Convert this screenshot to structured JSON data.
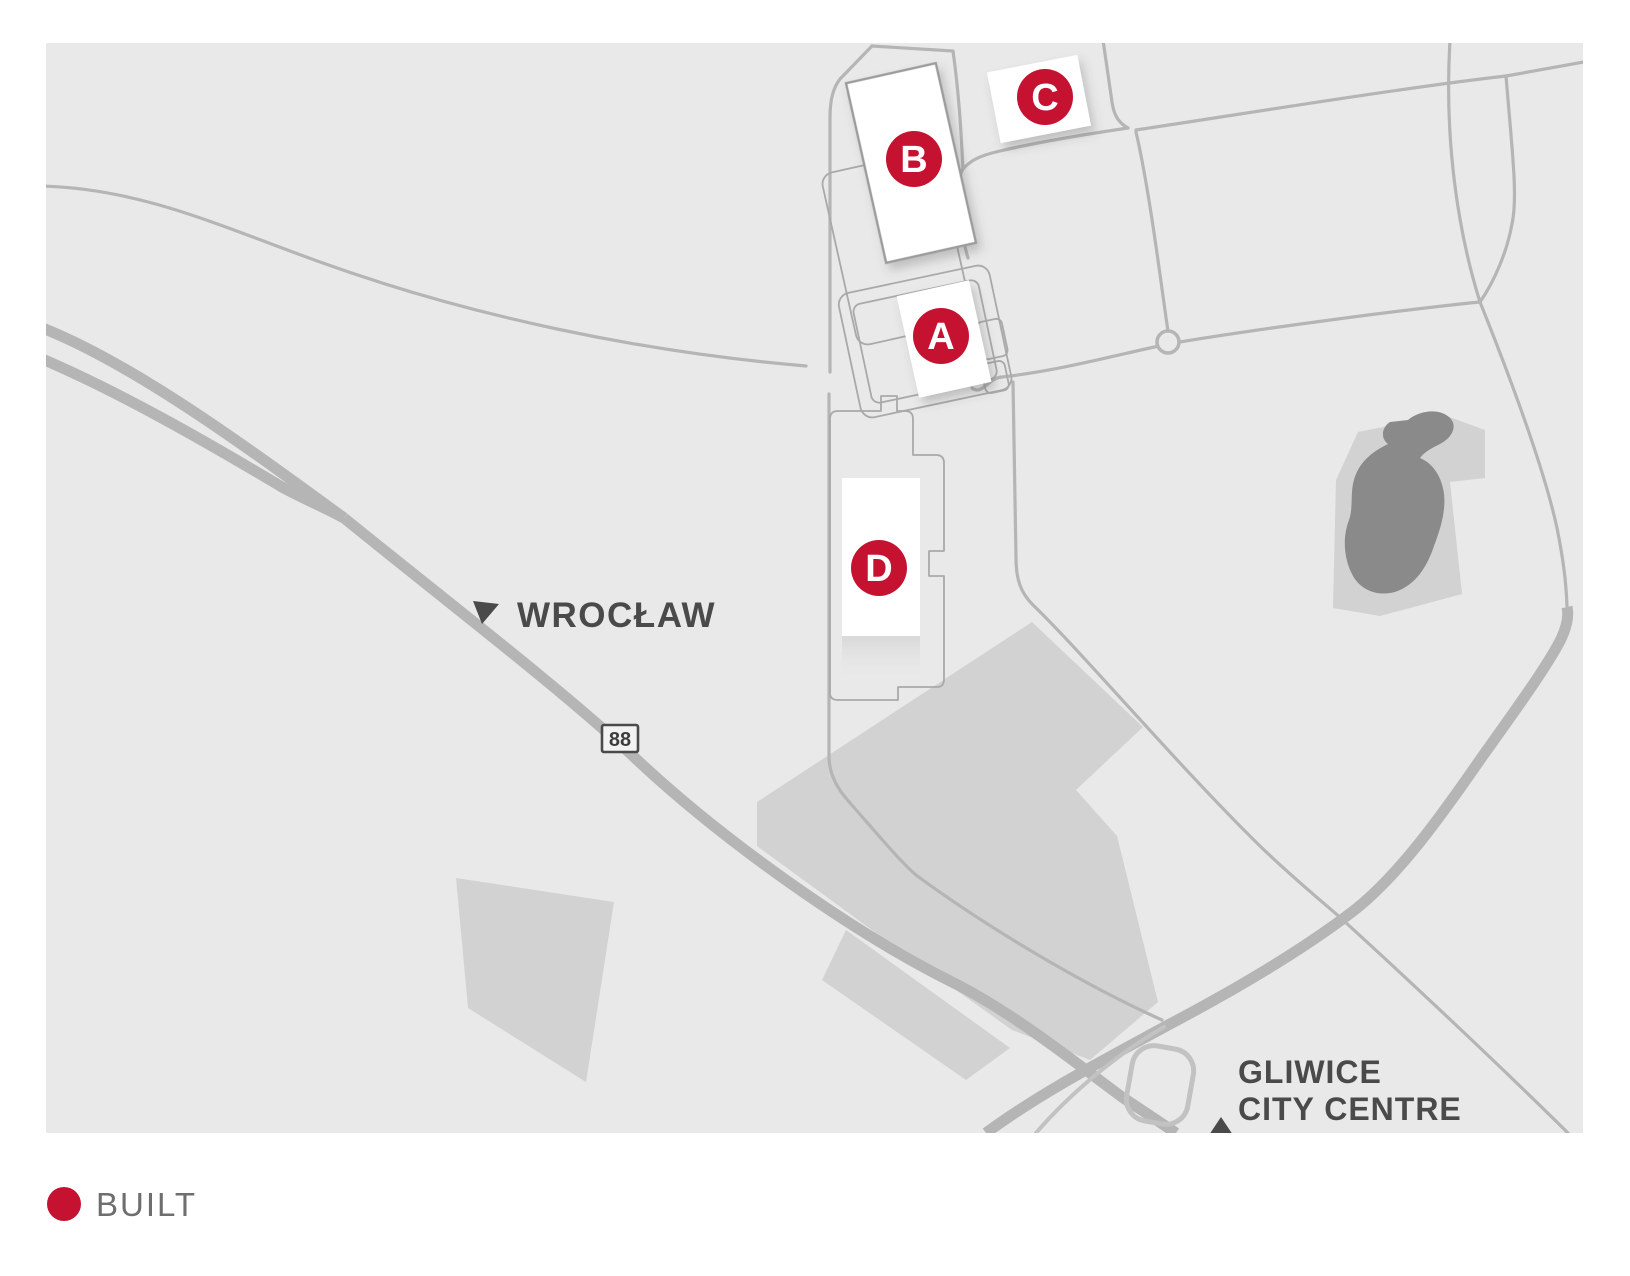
{
  "map": {
    "markers": [
      {
        "id": "site-a",
        "letter": "A",
        "status": "built"
      },
      {
        "id": "site-b",
        "letter": "B",
        "status": "built"
      },
      {
        "id": "site-c",
        "letter": "C",
        "status": "built"
      },
      {
        "id": "site-d",
        "letter": "D",
        "status": "built"
      }
    ],
    "labels": {
      "wroclaw": "WROCŁAW",
      "road_number": "88",
      "gliwice_line1": "GLIWICE",
      "gliwice_line2": "CITY CENTRE"
    }
  },
  "legend": {
    "built_label": "BUILT"
  },
  "colors": {
    "marker_red": "#c51230",
    "marker_letter": "#ffffff",
    "map_label_gray": "#4a4a4a",
    "shield_text_gray": "#3d3d3d",
    "legend_text_gray": "#6e6e6e",
    "map_background": "#e9e9e9",
    "road_gray": "#b5b5b5",
    "outline_gray": "#a9a9a9",
    "parcel_gray": "#d2d2d2",
    "water_gray": "#8a8a8a",
    "building_white": "#ffffff"
  }
}
